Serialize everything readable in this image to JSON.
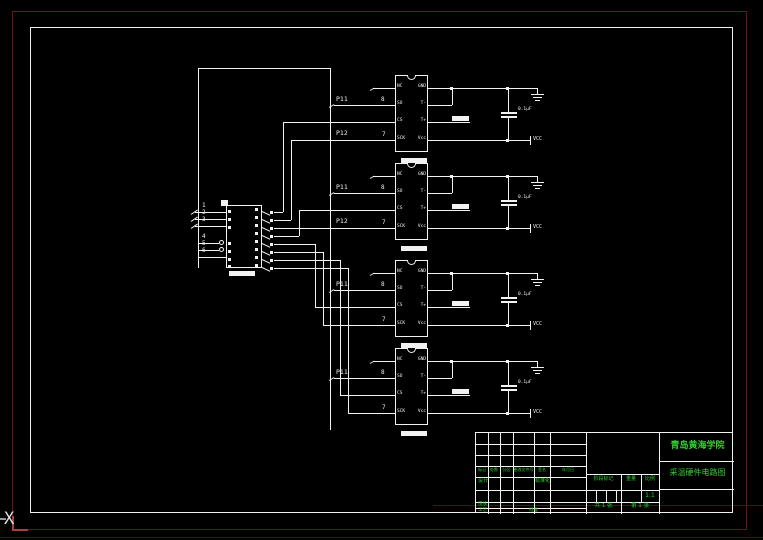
{
  "canvas": {
    "background": "#000000",
    "frame_color": "#f2f2f2",
    "red_border_color": "#6e1212",
    "green_text_color": "#2fd12f"
  },
  "ucs_icon": {
    "label": "X"
  },
  "connector": {
    "pin_labels_top": [
      "1",
      "2",
      "3"
    ],
    "pin_labels_bottom": [
      "4",
      "5",
      "6"
    ]
  },
  "chips": {
    "left_pin_names": [
      "NC",
      "SO",
      "CS",
      "SCK"
    ],
    "right_pin_names": [
      "GND",
      "T-",
      "T+",
      "Vcc"
    ],
    "capacitor_label": "0.1μF",
    "power_label": "VCC",
    "instances": [
      {
        "so_net": "P11",
        "so_pin": "8",
        "sck_net": "P12",
        "sck_pin": "7"
      },
      {
        "so_net": "P11",
        "so_pin": "8",
        "sck_net": "P12",
        "sck_pin": "7"
      },
      {
        "so_net": "P11",
        "so_pin": "8",
        "sck_net": "",
        "sck_pin": "7"
      },
      {
        "so_net": "P11",
        "so_pin": "8",
        "sck_net": "",
        "sck_pin": "7"
      }
    ]
  },
  "title_block": {
    "school": "青岛黄海学院",
    "drawing_title": "采温硬件电路图",
    "rev_headers": [
      "标记",
      "处数",
      "分区",
      "更改文件号",
      "签名",
      "年月日"
    ],
    "design_label": "设计",
    "standardization_label": "标准化",
    "review_label": "审核",
    "process_label": "工艺",
    "approve_label": "批准",
    "stage_label": "阶段标记",
    "weight_label": "重量",
    "scale_label": "比例",
    "scale_value": "1:1",
    "sheet_total": "共 1 张",
    "sheet_number": "第 1 张"
  }
}
